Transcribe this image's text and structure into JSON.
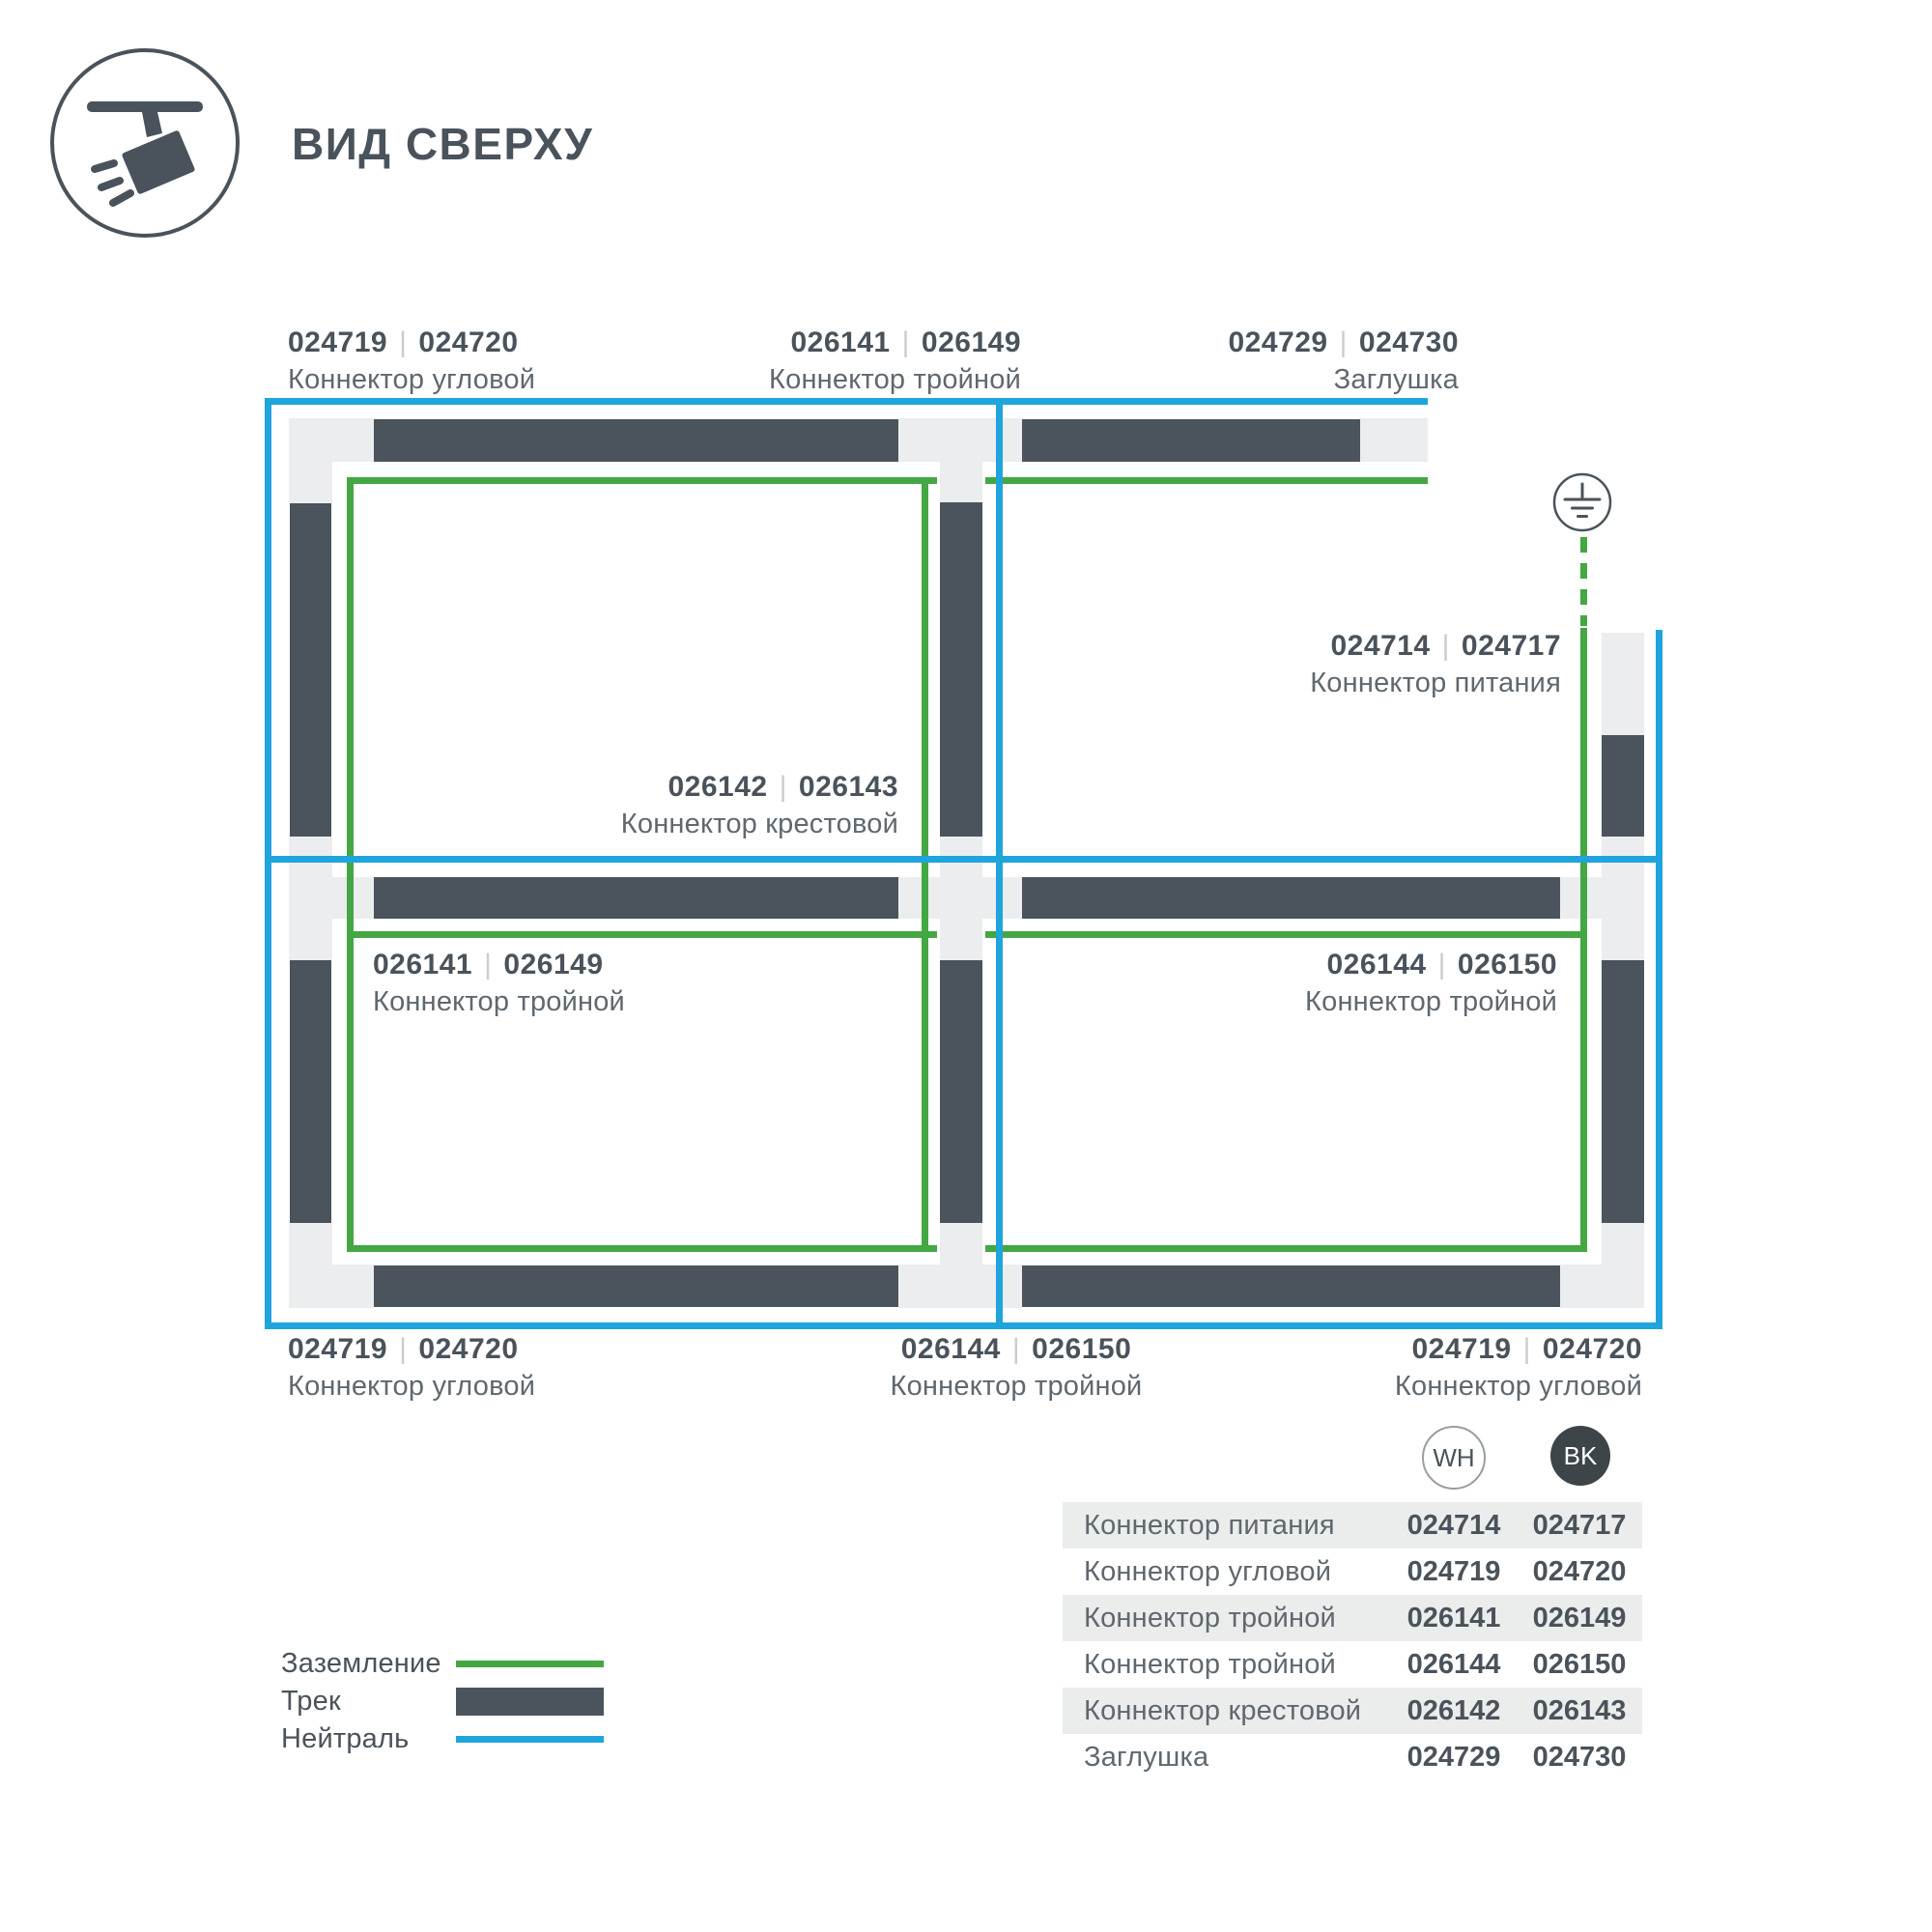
{
  "title": "ВИД СВЕРХУ",
  "colors": {
    "track": "#4B545C",
    "connector": "#EBEDEE",
    "ground": "#43A843",
    "neutral": "#1FA4DC",
    "code": "#4A535B",
    "name": "#5F686F",
    "sep": "#C9CDD0",
    "rowbg": "#EBECEC",
    "bk": "#3E4548",
    "whstroke": "#979EA3"
  },
  "diagram": {
    "separator": "|",
    "labels": [
      {
        "wh": "024719",
        "bk": "024720",
        "name": "Коннектор угловой"
      },
      {
        "wh": "026141",
        "bk": "026149",
        "name": "Коннектор тройной"
      },
      {
        "wh": "024729",
        "bk": "024730",
        "name": "Заглушка"
      },
      {
        "wh": "024714",
        "bk": "024717",
        "name": "Коннектор питания"
      },
      {
        "wh": "026142",
        "bk": "026143",
        "name": "Коннектор крестовой"
      },
      {
        "wh": "026141",
        "bk": "026149",
        "name": "Коннектор тройной"
      },
      {
        "wh": "026144",
        "bk": "026150",
        "name": "Коннектор тройной"
      },
      {
        "wh": "024719",
        "bk": "024720",
        "name": "Коннектор угловой"
      },
      {
        "wh": "026144",
        "bk": "026150",
        "name": "Коннектор тройной"
      },
      {
        "wh": "024719",
        "bk": "024720",
        "name": "Коннектор угловой"
      }
    ]
  },
  "legend": {
    "items": [
      {
        "label": "Заземление"
      },
      {
        "label": "Трек"
      },
      {
        "label": "Нейтраль"
      }
    ]
  },
  "table": {
    "columns": [
      {
        "label": "WH"
      },
      {
        "label": "BK"
      }
    ],
    "rows": [
      {
        "name": "Коннектор питания",
        "wh": "024714",
        "bk": "024717"
      },
      {
        "name": "Коннектор угловой",
        "wh": "024719",
        "bk": "024720"
      },
      {
        "name": "Коннектор тройной",
        "wh": "026141",
        "bk": "026149"
      },
      {
        "name": "Коннектор тройной",
        "wh": "026144",
        "bk": "026150"
      },
      {
        "name": "Коннектор крестовой",
        "wh": "026142",
        "bk": "026143"
      },
      {
        "name": "Заглушка",
        "wh": "024729",
        "bk": "024730"
      }
    ]
  }
}
